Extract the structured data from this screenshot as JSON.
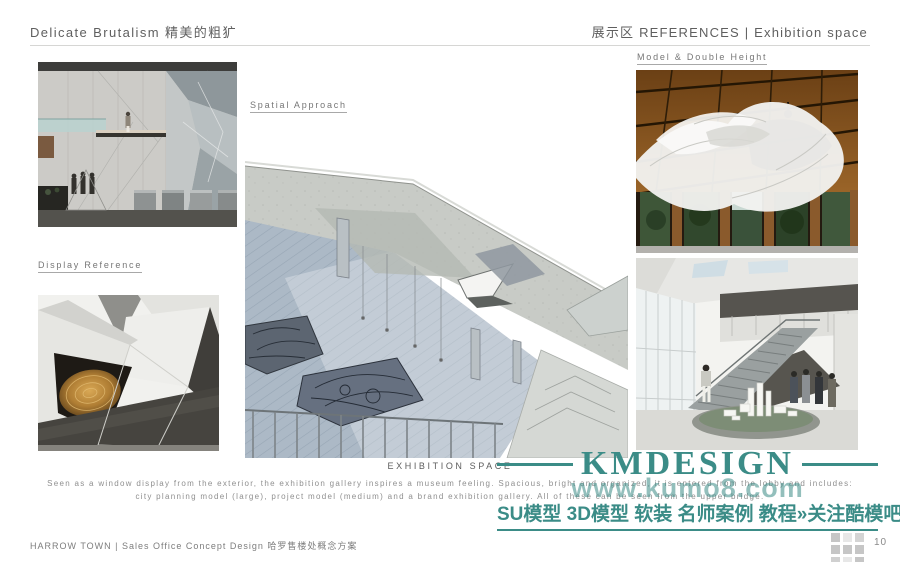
{
  "header": {
    "title_left": "Delicate Brutalism 精美的粗犷",
    "title_right": "展示区 REFERENCES | Exhibition space"
  },
  "labels": {
    "spatial_approach": "Spatial Approach",
    "display_reference": "Display Reference",
    "model_double_height": "Model & Double Height"
  },
  "caption": {
    "title": "EXHIBITION SPACE",
    "line1": "Seen as a window display from the exterior, the exhibition gallery inspires a museum feeling. Spacious, bright and organized, it is entered from the lobby and includes:",
    "line2": "city planning model (large), project model (medium) and a brand exhibition gallery. All of these can be seen from the upper bridge."
  },
  "watermark": {
    "brand": "KMDESIGN",
    "url": "www.kumo8.com",
    "tagline": "SU模型 3D模型 软装 名师案例 教程»关注酷模吧",
    "color": "#3b8c87"
  },
  "footer": {
    "project": "HARROW TOWN | Sales Office Concept Design 哈罗售楼处概念方案",
    "page_number": "10"
  },
  "icons": {
    "footer_grid": "grid-icon"
  },
  "images": {
    "left_top": "sales-gallery-section-render",
    "left_bottom": "faceted-display-reference-photo",
    "middle": "exhibition-space-axonometric-drawing",
    "right_top": "ceiling-model-sculpture-photo",
    "right_bottom": "double-height-atrium-render"
  }
}
